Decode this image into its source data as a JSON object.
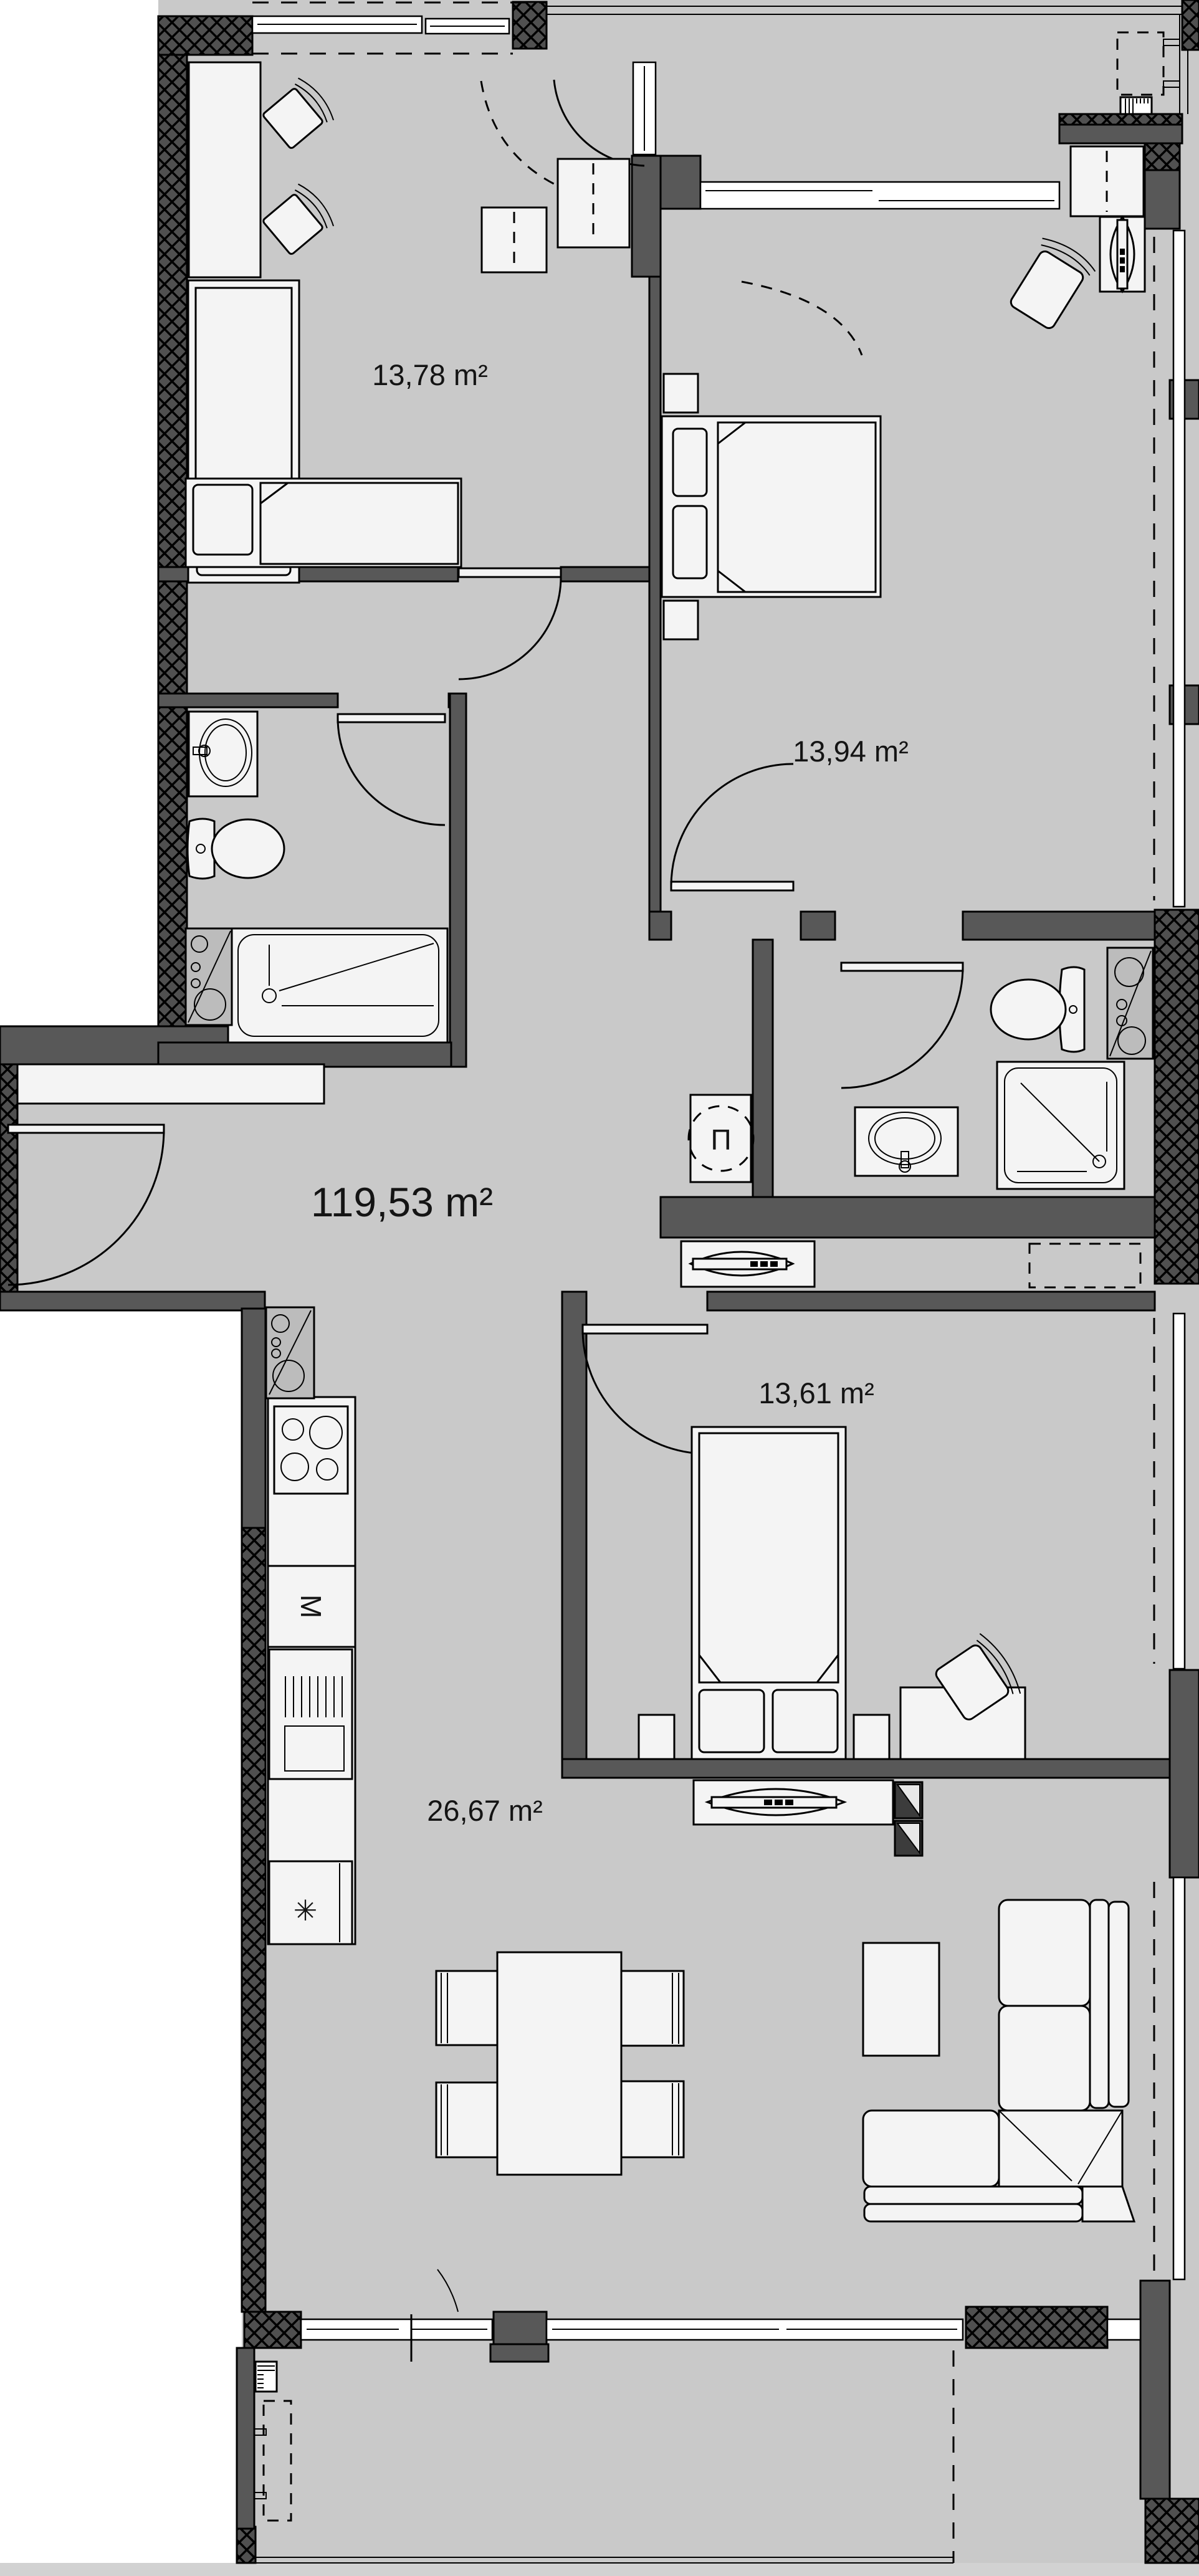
{
  "plan": {
    "type": "apartment-floor-plan",
    "rooms": [
      {
        "id": "room-top-left",
        "area_label": "13,78 m²"
      },
      {
        "id": "bedroom-top-right",
        "area_label": "13,94 m²"
      },
      {
        "id": "total-area",
        "area_label": "119,53 m²"
      },
      {
        "id": "bedroom-bottom",
        "area_label": "13,61 m²"
      },
      {
        "id": "living-kitchen",
        "area_label": "26,67 m²"
      }
    ],
    "symbols": {
      "washing_machine": "П",
      "microwave": "M",
      "fridge": "✳"
    },
    "colors": {
      "floor": "#c9c9c9",
      "wall": "#585858",
      "furniture": "#f4f4f4",
      "appliance": "#bcbcbc",
      "outside": "#ffffff",
      "line": "#000000"
    }
  }
}
